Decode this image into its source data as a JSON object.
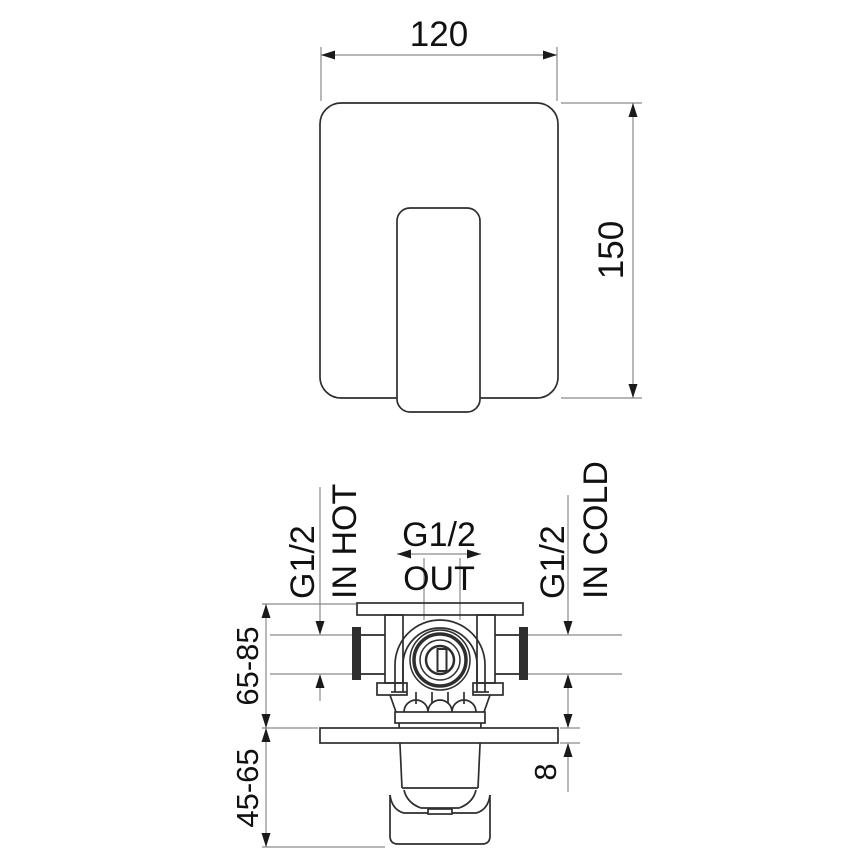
{
  "drawing": {
    "front_view": {
      "width": "120",
      "height": "150"
    },
    "section_view": {
      "hot_port": {
        "thread": "G1/2",
        "name": "IN HOT"
      },
      "out_port": {
        "thread": "G1/2",
        "name": "OUT"
      },
      "cold_port": {
        "thread": "G1/2",
        "name": "IN COLD"
      },
      "mounting_depth_range": "65-85",
      "trim_depth_range": "45-65",
      "plate_thickness": "8"
    },
    "colors": {
      "outline": "#2e2e2e",
      "dim_line": "#8a8a8a",
      "arrow": "#1a1a1a",
      "text": "#111111",
      "background": "#ffffff"
    }
  }
}
